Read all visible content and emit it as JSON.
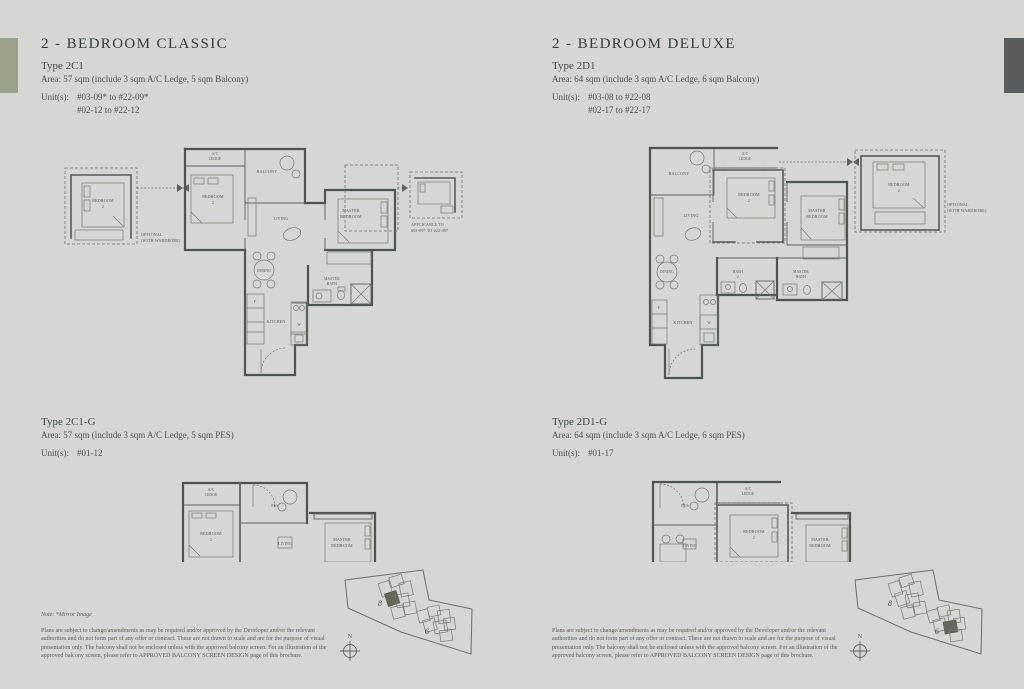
{
  "page": {
    "background": "#d6d7d4",
    "left_tab_color": "#9aa28c",
    "right_tab_color": "#585c5d",
    "heading_color": "#343b32",
    "body_color": "#4b5047"
  },
  "left_column": {
    "title": "2 - BEDROOM CLASSIC",
    "upper": {
      "type_name": "Type 2C1",
      "area": "Area: 57 sqm (include 3 sqm A/C Ledge, 5 sqm Balcony)",
      "units_label": "Unit(s):",
      "unit_lines": [
        "#03-09* to #22-09*",
        "#02-12 to #22-12"
      ]
    },
    "lower": {
      "type_name": "Type 2C1-G",
      "area": "Area: 57 sqm (include 3 sqm A/C Ledge, 5 sqm PES)",
      "units_label": "Unit(s):",
      "unit_lines": [
        "#01-12"
      ]
    },
    "note": "Note: *Mirror Image",
    "disclaimer": "Plans are subject to change/amendments as may be required and/or approved by the Developer and/or the relevant authorities and do not form part of any offer or contract. These are not drawn to scale and are for the purpose of visual presentation only. The balcony shall not be enclosed unless with the approved balcony screen. For an illustration of the approved balcony screen, please refer to APPROVED BALCONY SCREEN DESIGN page of this brochure."
  },
  "right_column": {
    "title": "2 - BEDROOM DELUXE",
    "upper": {
      "type_name": "Type 2D1",
      "area": "Area: 64 sqm (include 3 sqm A/C Ledge, 6 sqm Balcony)",
      "units_label": "Unit(s):",
      "unit_lines": [
        "#03-08 to #22-08",
        "#02-17 to #22-17"
      ]
    },
    "lower": {
      "type_name": "Type 2D1-G",
      "area": "Area: 64 sqm (include 3 sqm A/C Ledge, 6 sqm PES)",
      "units_label": "Unit(s):",
      "unit_lines": [
        "#01-17"
      ]
    },
    "disclaimer": "Plans are subject to change/amendments as may be required and/or approved by the Developer and/or the relevant authorities and do not form part of any offer or contract. These are not drawn to scale and are for the purpose of visual presentation only. The balcony shall not be enclosed unless with the approved balcony screen. For an illustration of the approved balcony screen, please refer to APPROVED BALCONY SCREEN DESIGN page of this brochure."
  },
  "plan_labels": {
    "ac": "A/C",
    "ledge": "LEDGE",
    "balcony": "BALCONY",
    "bedroom": "BEDROOM",
    "two": "2",
    "master": "MASTER",
    "living": "LIVING",
    "dining": "DINING",
    "kitchen": "KITCHEN",
    "bath": "BATH",
    "pes": "PES",
    "f": "F",
    "w": "W",
    "optional_1": "OPTIONAL",
    "optional_2": "(WITH WARDROBE)",
    "applicable_1": "APPLICABLE TO",
    "applicable_2": "#03-09* TO #22-09*"
  },
  "key_plan": {
    "block_8": "8",
    "block_6": "6",
    "north": "N"
  }
}
